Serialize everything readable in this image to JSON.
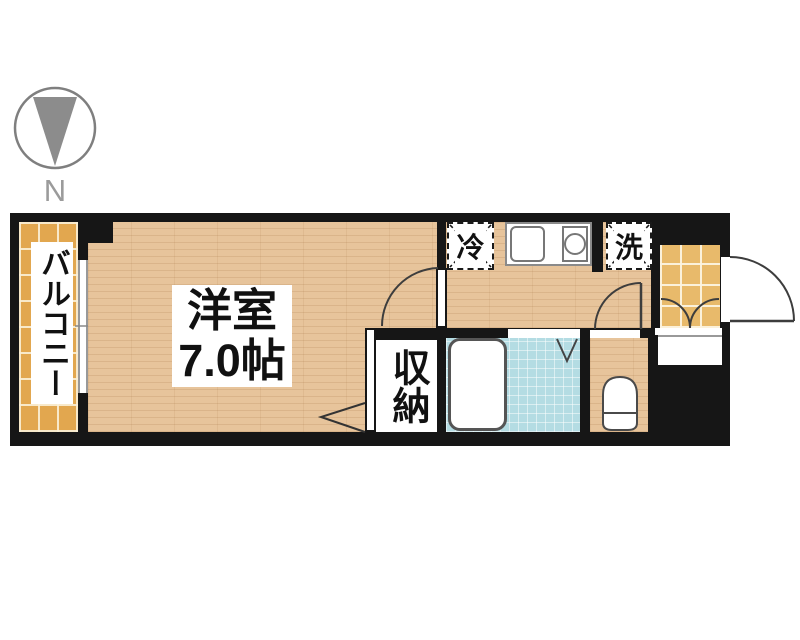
{
  "plan": {
    "type": "apartment-floor-plan",
    "compass_label": "N",
    "rooms": {
      "balcony": "バルコニー",
      "main_room_name": "洋室",
      "main_room_size": "7.0帖",
      "closet": "収納",
      "refrigerator_space": "冷",
      "washer_space": "洗"
    },
    "fixtures": [
      "north-arrow",
      "balcony-window",
      "kitchen-counter",
      "kitchen-sink",
      "stove-burner",
      "refrigerator-space",
      "washing-machine-space",
      "bathtub",
      "bath-folding-door",
      "toilet",
      "closet-door",
      "room-entry-door",
      "toilet-door",
      "entrance-door",
      "shoe-cabinet"
    ],
    "colors": {
      "wall": "#161616",
      "wood_floor": "#e7c49b",
      "balcony_tile": "#e2a74f",
      "entrance_tile": "#e8ba6b",
      "bath_tile": "#b4dce3",
      "outline": "#3d3d3d",
      "compass_gray": "#8c8c8c"
    }
  }
}
